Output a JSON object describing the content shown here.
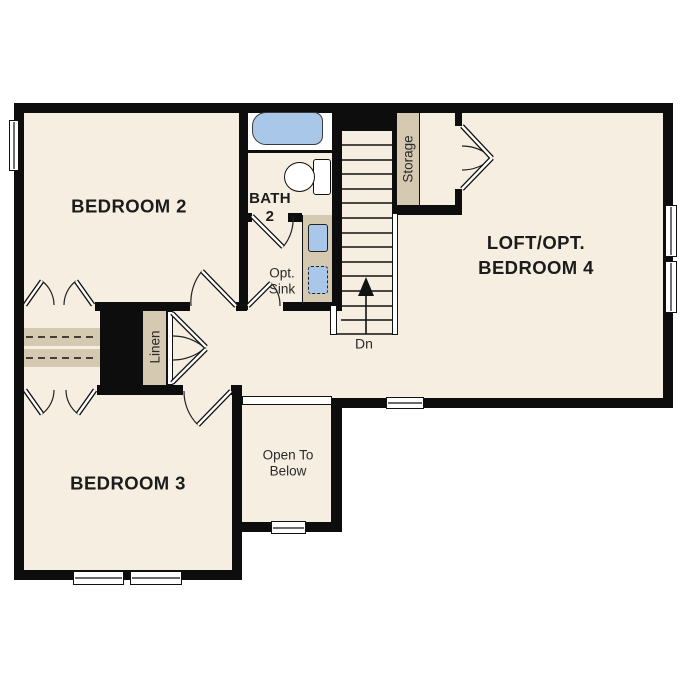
{
  "plan": {
    "title": "second-floor-plan",
    "rooms": {
      "bedroom2": "BEDROOM 2",
      "bath_line1": "BATH",
      "bath_line2": "2",
      "opt_sink_line1": "Opt.",
      "opt_sink_line2": "Sink",
      "linen": "Linen",
      "storage": "Storage",
      "loft_line1": "LOFT/OPT.",
      "loft_line2": "BEDROOM 4",
      "stairs_down": "Dn",
      "bedroom3": "BEDROOM 3",
      "open_below_line1": "Open To",
      "open_below_line2": "Below"
    },
    "colors": {
      "floor": "#f6eee1",
      "wall": "#0d0d0d",
      "wood": "#d5c9b2",
      "blue": "#a9c8e9",
      "bg": "#ffffff",
      "ink": "#1c1c1c"
    }
  }
}
